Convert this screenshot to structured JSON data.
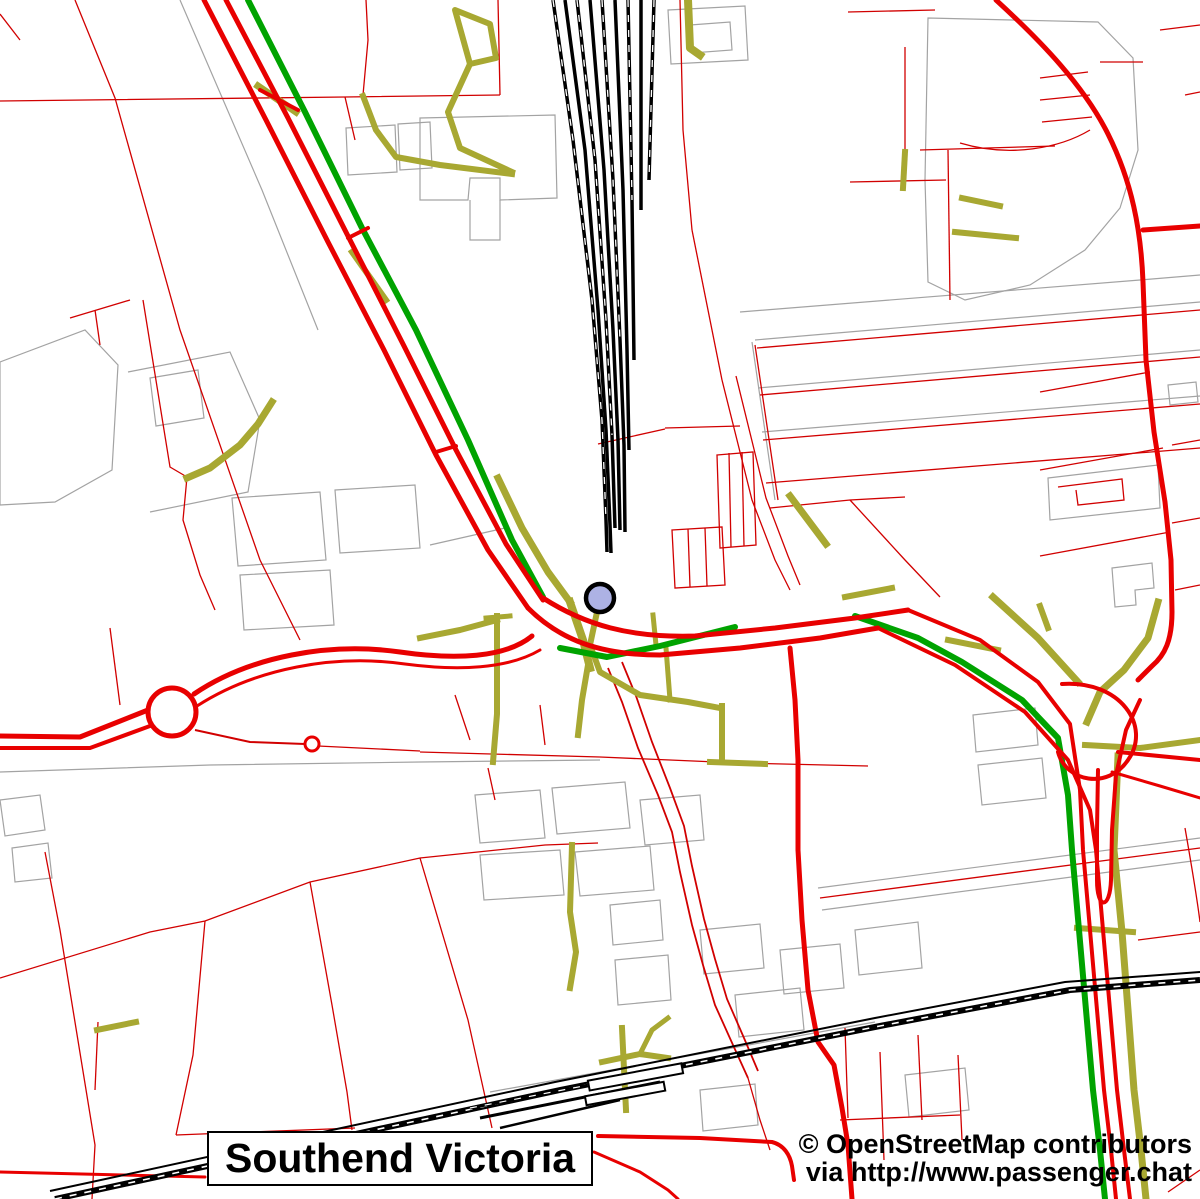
{
  "map": {
    "title": "Southend Victoria",
    "station_label": "Southend Victoria",
    "attribution_line1": "© OpenStreetMap contributors",
    "attribution_line2": "via http://www.passenger.chat",
    "marker": {
      "name": "station-marker",
      "x": 600,
      "y": 598,
      "radius": 14,
      "fill": "#adb2e4",
      "outline": "#000000"
    },
    "colors": {
      "thin-red": "#d10000",
      "thick-red": "#e80000",
      "route-green": "#00a300",
      "path-olive": "#a8a832",
      "building-gray": "#a3a3a3",
      "rail-black": "#000000",
      "background": "#ffffff"
    },
    "layers": [
      "building-outlines",
      "boundary-lines",
      "footpaths",
      "cycle-routes",
      "primary-roads",
      "railways",
      "station-marker"
    ]
  }
}
